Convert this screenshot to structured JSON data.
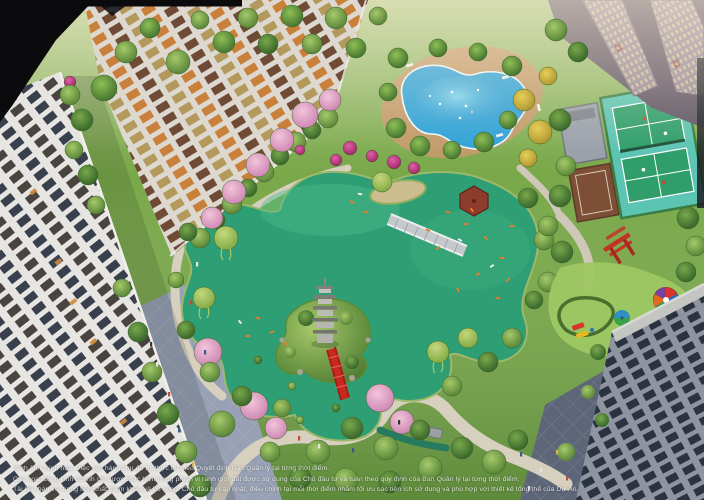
{
  "scene": {
    "type": "architectural-aerial-render",
    "alt": "Aerial render of residential towers around a koi lake with pool, tennis courts and playground",
    "rooftop_markings": {
      "tower_a": "21",
      "tower_b": "21"
    }
  },
  "colors": {
    "lawn": "#79a849",
    "pond": "#2e9e74",
    "pond_light": "#4cbb8e",
    "pool_water": "#2ea2d8",
    "pool_deck": "#c49a6c",
    "court_surface": "#5cc4b2",
    "court_green": "#2f9e6b",
    "bridge_red": "#c8291f",
    "torii_red": "#c23326",
    "pagoda_grey": "#b4b2ac",
    "cherry_pink": "#dd9ec6",
    "tower_white": "#e8e6e2",
    "window_dark": "#39404d",
    "window_lit": "#c9803a",
    "plaza_dark": "#5d6578",
    "plaza_light": "#97a0b4",
    "path_stone": "#d7d0bf",
    "koi_orange": "#f07a28"
  },
  "disclaimer": {
    "line1": "Hình ảnh minh họa. Việc vận hành khu đô thị thực thi theo Quyết định Ban Quản lý tại từng thời điểm.",
    "line2": "Các hoạt động kinh doanh chỉ được thực hiện trong phạm vi ranh giới đất được sử dụng của Chủ đầu tư và tuân theo quy định của Ban Quản lý tại từng thời điểm.",
    "line3": "Tài liệu bán về mang tính chất tham khảo và bổ sung. Chủ đầu tư cập nhật, điều chỉnh tại mỗi thời điểm nhằm tối ưu các tiện ích sử dụng và phù hợp với thiết kế tổng thể của Dự Án."
  }
}
